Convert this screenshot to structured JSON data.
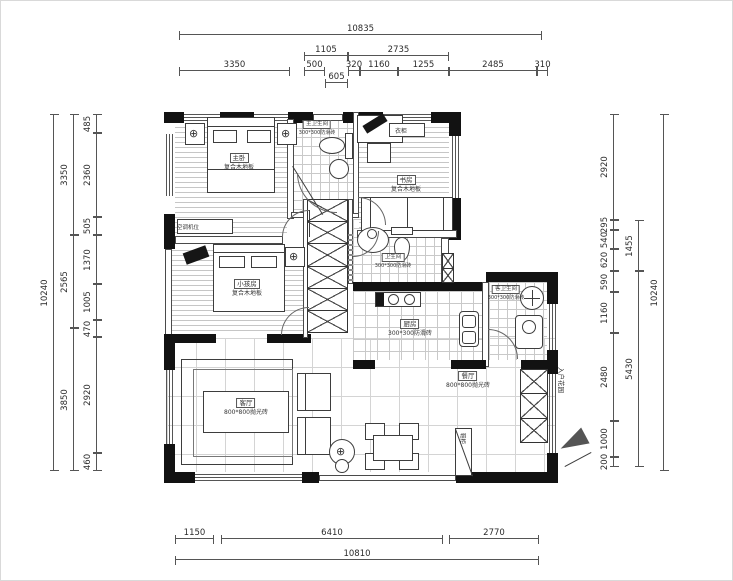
{
  "dims": {
    "top": {
      "total": "10835",
      "row2": [
        "1105",
        "2735"
      ],
      "row3": [
        "3350",
        "500",
        "320",
        "1160",
        "1255",
        "2485",
        "310"
      ],
      "row4": [
        "605"
      ]
    },
    "bottom": {
      "row1": [
        "1150",
        "6410",
        "2770"
      ],
      "total": "10810"
    },
    "left": {
      "outer": "10240",
      "mid": [
        "3350",
        "2565",
        "3850"
      ],
      "inner": [
        "485",
        "2360",
        "505",
        "1370",
        "1005",
        "470",
        "2920",
        "460"
      ]
    },
    "right": {
      "outer": "10240",
      "mid": [
        "1455",
        "5430"
      ],
      "inner": [
        "2920",
        "295",
        "540",
        "620",
        "590",
        "1160",
        "2480",
        "1000",
        "200"
      ]
    }
  },
  "rooms": {
    "master": {
      "name": "主卧",
      "floor": "复合木地板"
    },
    "study": {
      "name": "书房",
      "floor": "复合木地板"
    },
    "kids": {
      "name": "小孩房",
      "floor": "复合木地板"
    },
    "living": {
      "name": "客厅",
      "floor": "800*800抛光砖"
    },
    "dining": {
      "name": "餐厅",
      "floor": "800*800抛光砖"
    },
    "kitchen": {
      "name": "厨房",
      "floor": "300*300防滑砖"
    },
    "bath_master": {
      "name": "主卫生间",
      "floor": "300*300防滑砖"
    },
    "bath_hall": {
      "name": "卫生间",
      "floor": "300*300防滑砖"
    },
    "bath_guest": {
      "name": "客卫生间",
      "floor": "300*300防滑砖"
    }
  },
  "annotations": {
    "entry_garden": "入户花园",
    "wardrobe": "衣柜",
    "shoe_cabinet": "鞋柜",
    "ac_unit": "空调机位"
  },
  "colors": {
    "wall": "#121212",
    "line": "#555555",
    "hatch": "#c6c6c6"
  }
}
